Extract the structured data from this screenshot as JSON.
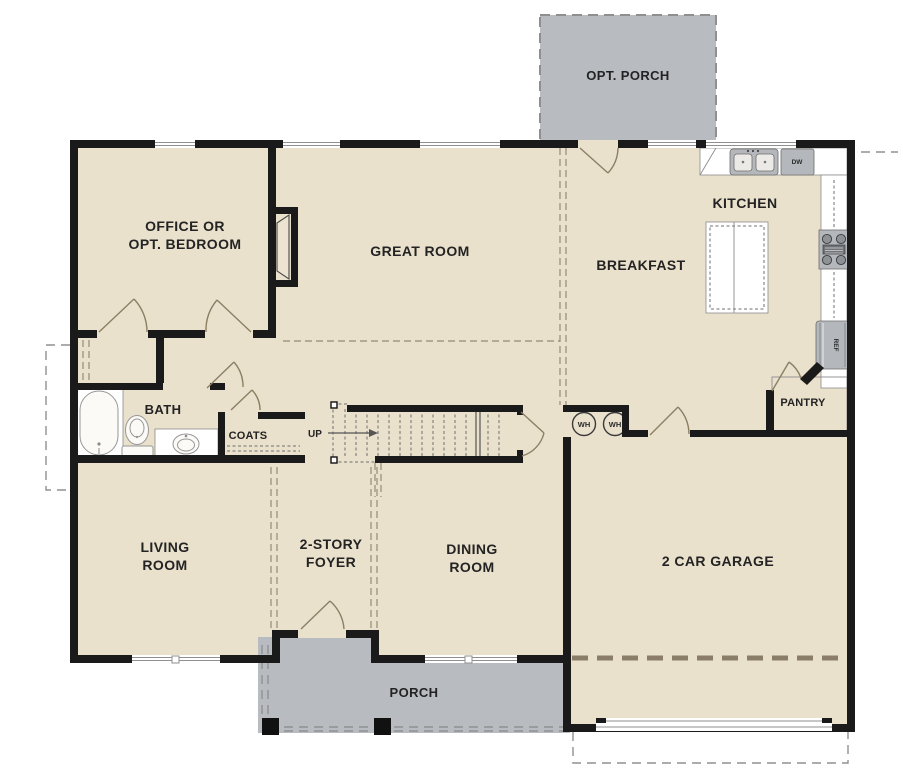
{
  "plan": {
    "title": "first-floor-plan",
    "rooms": {
      "opt_porch": "OPT. PORCH",
      "office_line1": "OFFICE OR",
      "office_line2": "OPT. BEDROOM",
      "great_room": "GREAT ROOM",
      "breakfast": "BREAKFAST",
      "kitchen": "KITCHEN",
      "bath": "BATH",
      "coats": "COATS",
      "pantry": "PANTRY",
      "living_line1": "LIVING",
      "living_line2": "ROOM",
      "foyer_line1": "2-STORY",
      "foyer_line2": "FOYER",
      "dining_line1": "DINING",
      "dining_line2": "ROOM",
      "garage": "2 CAR GARAGE",
      "porch": "PORCH"
    },
    "annotations": {
      "up": "UP",
      "wh1": "WH",
      "wh2": "WH",
      "dw": "DW",
      "ref": "REF"
    },
    "colors": {
      "floor": "#eae1cd",
      "porch": "#b8bcc0",
      "wall": "#1a1a1a",
      "door": "#8b7f63",
      "ceiling_dash": "#948b77",
      "appliance": "#b4b8bc"
    }
  }
}
